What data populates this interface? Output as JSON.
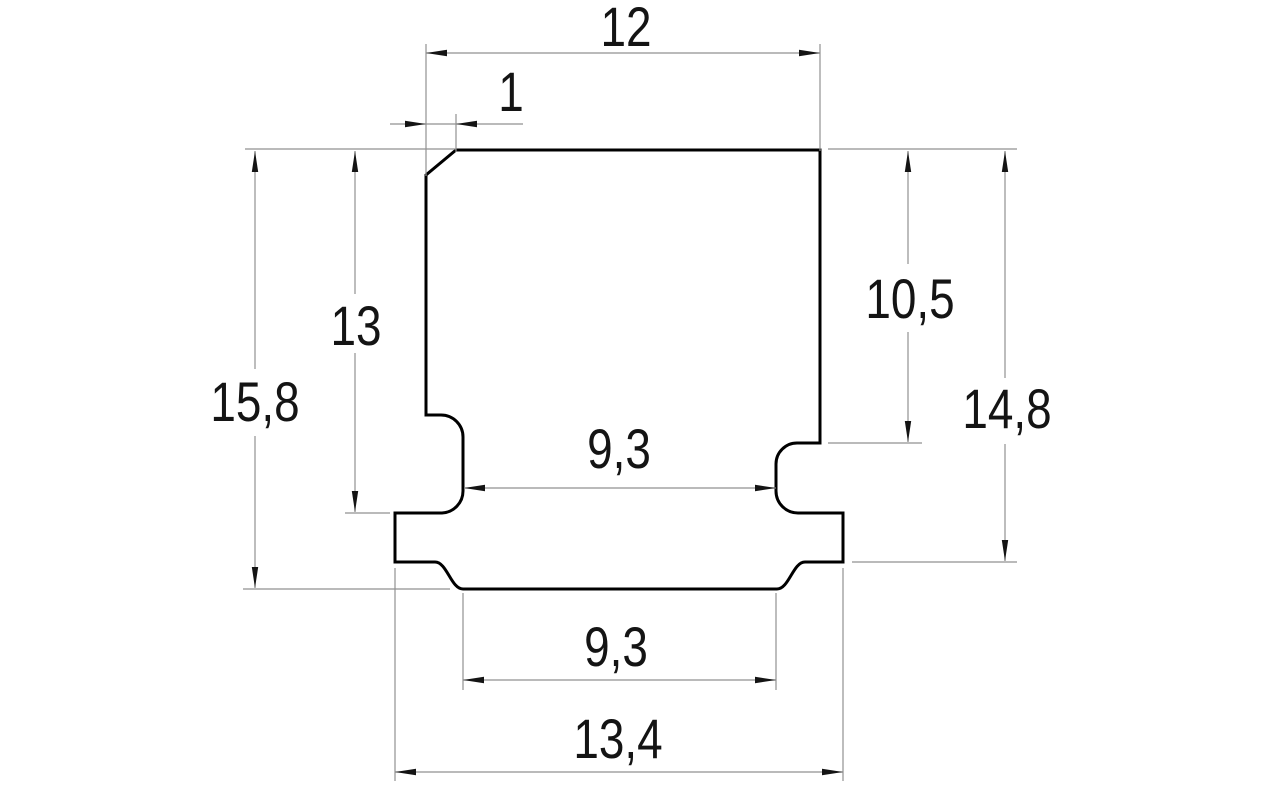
{
  "drawing": {
    "kind": "technical-dimension-drawing",
    "subject": "T-slot profile cross-section",
    "background": "#ffffff",
    "outline_color": "#000000",
    "thin_line_color": "#919191",
    "text_color": "#141414",
    "decimal_separator": ","
  },
  "dimensions": [
    {
      "id": "top-width",
      "label": "12",
      "value": 12,
      "orientation": "horizontal"
    },
    {
      "id": "chamfer-width",
      "label": "1",
      "value": 1,
      "orientation": "horizontal"
    },
    {
      "id": "overall-height",
      "label": "15,8",
      "value": 15.8,
      "orientation": "vertical"
    },
    {
      "id": "upper-section-height",
      "label": "13",
      "value": 13,
      "orientation": "vertical"
    },
    {
      "id": "undercut-depth",
      "label": "10,5",
      "value": 10.5,
      "orientation": "vertical"
    },
    {
      "id": "flange-bottom-depth",
      "label": "14,8",
      "value": 14.8,
      "orientation": "vertical"
    },
    {
      "id": "neck-width",
      "label": "9,3",
      "value": 9.3,
      "orientation": "horizontal"
    },
    {
      "id": "bottom-face-width",
      "label": "9,3",
      "value": 9.3,
      "orientation": "horizontal"
    },
    {
      "id": "flange-width",
      "label": "13,4",
      "value": 13.4,
      "orientation": "horizontal"
    }
  ]
}
